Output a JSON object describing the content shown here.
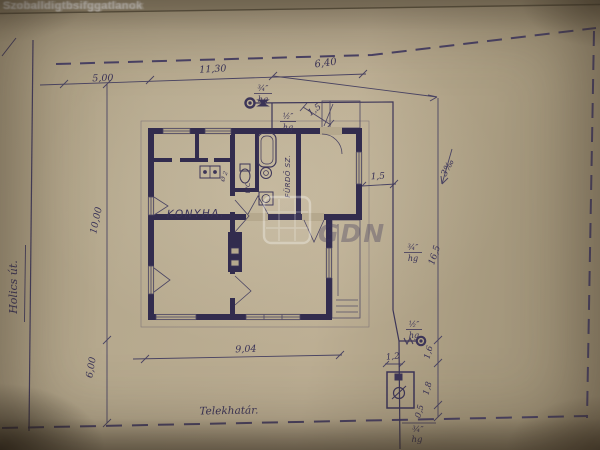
{
  "colors": {
    "paper": "#b5a88d",
    "ink": "#433c5e",
    "walls": "#322c4e",
    "watermark": "#ffffff"
  },
  "watermark": {
    "top_text": "Szoballdigtbsifggatlanok",
    "logo_text": "GDN"
  },
  "street": {
    "name": "Holics út."
  },
  "site": {
    "boundary_label": "Telekhatár."
  },
  "rooms": {
    "kitchen": "KONYHA.",
    "wc": "WC",
    "bathroom": "FÜRDŐ SZ."
  },
  "dims": {
    "top_left": "5,00",
    "top_mid": "11,30",
    "top_right": "6,40",
    "left_upper": "10,00",
    "left_lower": "6,00",
    "house_width": "9,04",
    "right_total": "16,5",
    "house_to_pipe": "1,5",
    "porch": "1,5",
    "tap_up": "1,6",
    "tap_down": "1,8",
    "to_boundary": "0,5",
    "pit_width": "1,2"
  },
  "pipe": {
    "main_size": "¾″",
    "main_mat": "hg",
    "service_size": "½″",
    "service_mat": "hg",
    "riser_size": "¾″",
    "riser_mat": "hg",
    "tap_size": "½″",
    "tap_mat": "hg",
    "street_size": "¾″",
    "street_mat": "hg",
    "slope": "3‰",
    "drain_note": "Ø 2"
  }
}
